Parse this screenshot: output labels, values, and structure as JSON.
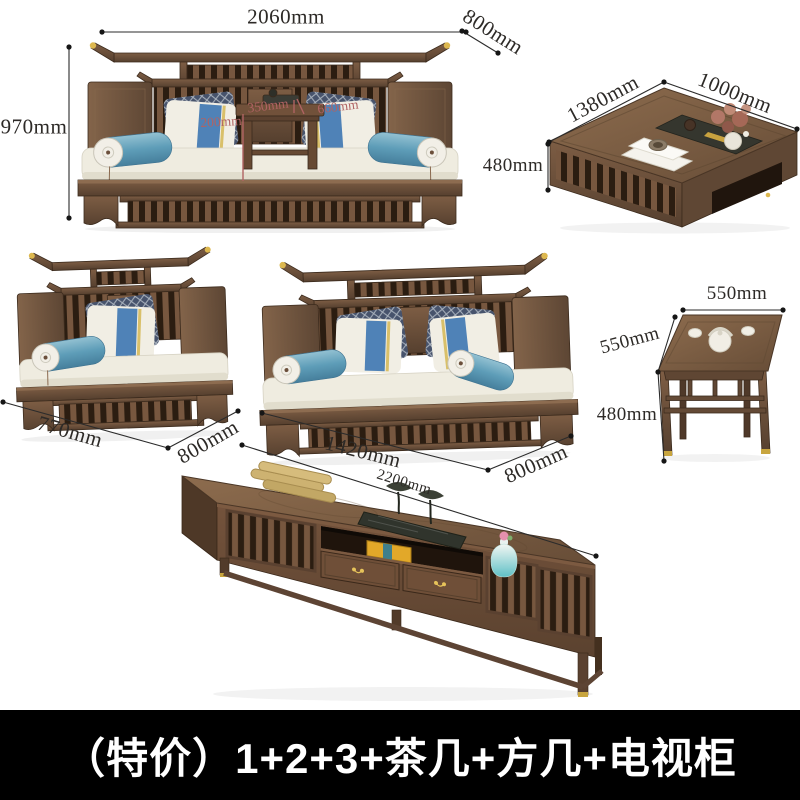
{
  "caption": {
    "text": "（特价）1+2+3+茶几+方几+电视柜"
  },
  "colors": {
    "dimension_text": "#2d2a27",
    "annotation_red": "#b06363",
    "caption_bg": "#000000",
    "caption_text": "#ffffff",
    "wood_dark": "#56402f",
    "wood_mid": "#7d5d44",
    "cushion_cream": "#efece0",
    "pillow_blue": "#4f82b7",
    "bolster_teal": "#5e9db8",
    "brass_gold": "#ddb84f"
  },
  "items": {
    "sofa_three_seat": {
      "width": "2060mm",
      "height": "970mm",
      "depth": "800mm",
      "tea_table_width": "350mm",
      "tea_table_depth": "660mm",
      "tea_table_height": "200mm"
    },
    "coffee_table": {
      "length": "1380mm",
      "depth": "1000mm",
      "height": "480mm"
    },
    "single_sofa": {
      "width": "770mm",
      "depth": "800mm"
    },
    "double_sofa": {
      "width": "1420mm",
      "depth": "800mm"
    },
    "square_table": {
      "width": "550mm",
      "depth": "550mm",
      "height": "480mm"
    },
    "tv_cabinet": {
      "width": "2200mm"
    }
  }
}
